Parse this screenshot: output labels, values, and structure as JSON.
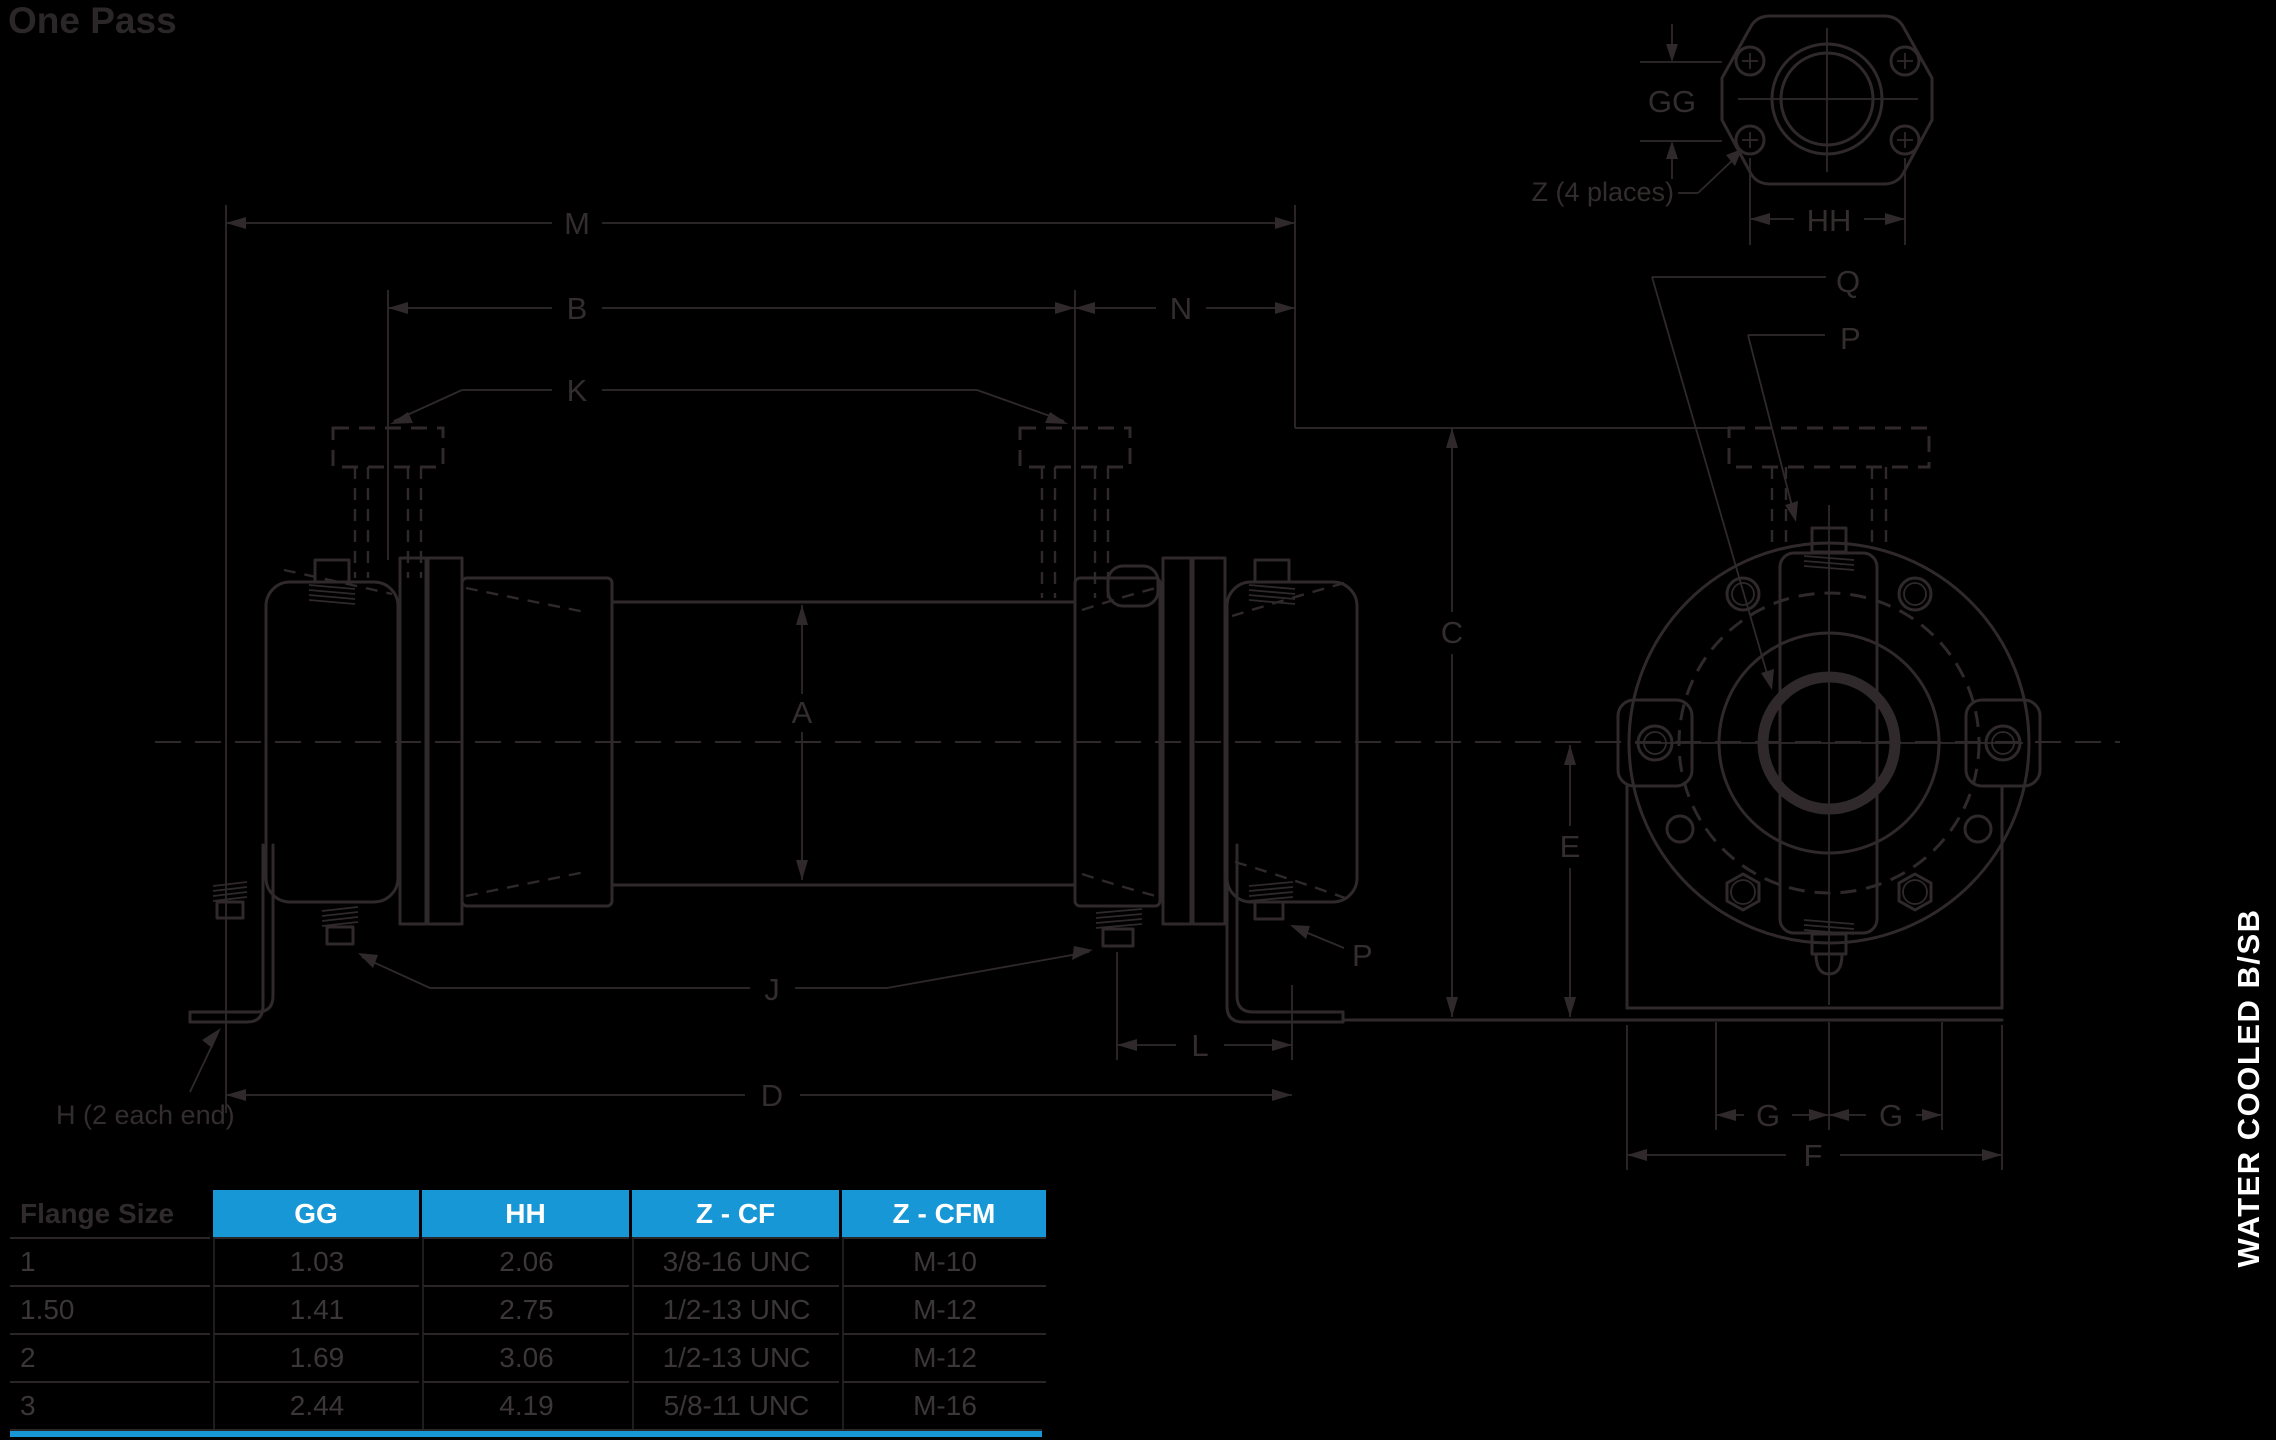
{
  "title": "One Pass",
  "banner": {
    "text": "WATER COOLED  B/SB"
  },
  "colors": {
    "background": "#000000",
    "line": "#2f292b",
    "accent_blue": "#1797d5",
    "banner_text": "#ffffff"
  },
  "drawing": {
    "dims": {
      "M": "M",
      "B": "B",
      "N": "N",
      "K": "K",
      "A": "A",
      "C": "C",
      "E": "E",
      "J": "J",
      "L": "L",
      "D": "D",
      "F": "F",
      "G_left": "G",
      "G_right": "G",
      "GG": "GG",
      "HH": "HH",
      "Q": "Q",
      "P_side": "P",
      "P_end": "P"
    },
    "notes": {
      "z": "Z (4 places)",
      "h": "H (2 each end)"
    }
  },
  "table": {
    "header": {
      "c0": "Flange Size",
      "c1": "GG",
      "c2": "HH",
      "c3": "Z - CF",
      "c4": "Z - CFM"
    },
    "rows": [
      {
        "c0": "1",
        "c1": "1.03",
        "c2": "2.06",
        "c3": "3/8-16 UNC",
        "c4": "M-10"
      },
      {
        "c0": "1.50",
        "c1": "1.41",
        "c2": "2.75",
        "c3": "1/2-13 UNC",
        "c4": "M-12"
      },
      {
        "c0": "2",
        "c1": "1.69",
        "c2": "3.06",
        "c3": "1/2-13 UNC",
        "c4": "M-12"
      },
      {
        "c0": "3",
        "c1": "2.44",
        "c2": "4.19",
        "c3": "5/8-11 UNC",
        "c4": "M-16"
      }
    ]
  }
}
